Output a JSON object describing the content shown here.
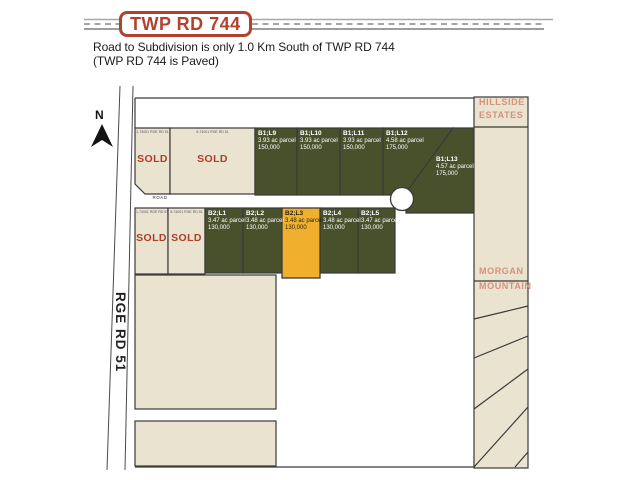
{
  "header": {
    "road_badge": "TWP RD 744",
    "note_line1": "Road to Subdivision is only 1.0 Km South of TWP RD 744",
    "note_line2": "(TWP RD 744 is Paved)"
  },
  "map": {
    "north_label": "N",
    "range_road_label": "RGE RD 51",
    "road_label": "ROAD",
    "sold_label": "SOLD",
    "neighbors": {
      "hillside_line1": "HILLSIDE",
      "hillside_line2": "ESTATES",
      "morgan_line1": "MORGAN",
      "morgan_line2": "MOUNTAIN"
    },
    "sold_lots": {
      "row1": [
        {
          "address": "2-74001 RGE RD 51"
        },
        {
          "address": "6-74001 RGE RD 51"
        }
      ],
      "row2": [
        {
          "address": "1-74001 RGE RD 51"
        },
        {
          "address": "5-74001 RGE RD 51"
        }
      ]
    },
    "lots": {
      "row1": [
        {
          "id": "B1;L9",
          "size": "3.93 ac parcel",
          "price": "150,000"
        },
        {
          "id": "B1;L10",
          "size": "3.93 ac parcel",
          "price": "150,000"
        },
        {
          "id": "B1;L11",
          "size": "3.93 ac parcel",
          "price": "150,000"
        },
        {
          "id": "B1;L12",
          "size": "4.58 ac parcel",
          "price": "175,000"
        },
        {
          "id": "B1;L13",
          "size": "4.57 ac parcel",
          "price": "175,000"
        }
      ],
      "row2": [
        {
          "id": "B2;L1",
          "size": "3.47 ac parcel",
          "price": "130,000"
        },
        {
          "id": "B2;L2",
          "size": "3.48 ac parcel",
          "price": "130,000"
        },
        {
          "id": "B2;L3",
          "size": "3.48 ac parcel",
          "price": "130,000",
          "highlighted": true
        },
        {
          "id": "B2;L4",
          "size": "3.48 ac parcel",
          "price": "130,000"
        },
        {
          "id": "B2;L5",
          "size": "3.47 ac parcel",
          "price": "130,000"
        }
      ]
    }
  },
  "colors": {
    "brand-red": "#b2422e",
    "sold-red": "#ad3e2a",
    "lot-green": "#49502c",
    "lot-yellow": "#f0b02d",
    "parcel-beige": "#eae3d0",
    "neighbor-salmon": "#d6917f",
    "line-dark": "#3a3a3a",
    "road-grey": "#9a9a9a",
    "text-dark": "#1f1f1f"
  }
}
